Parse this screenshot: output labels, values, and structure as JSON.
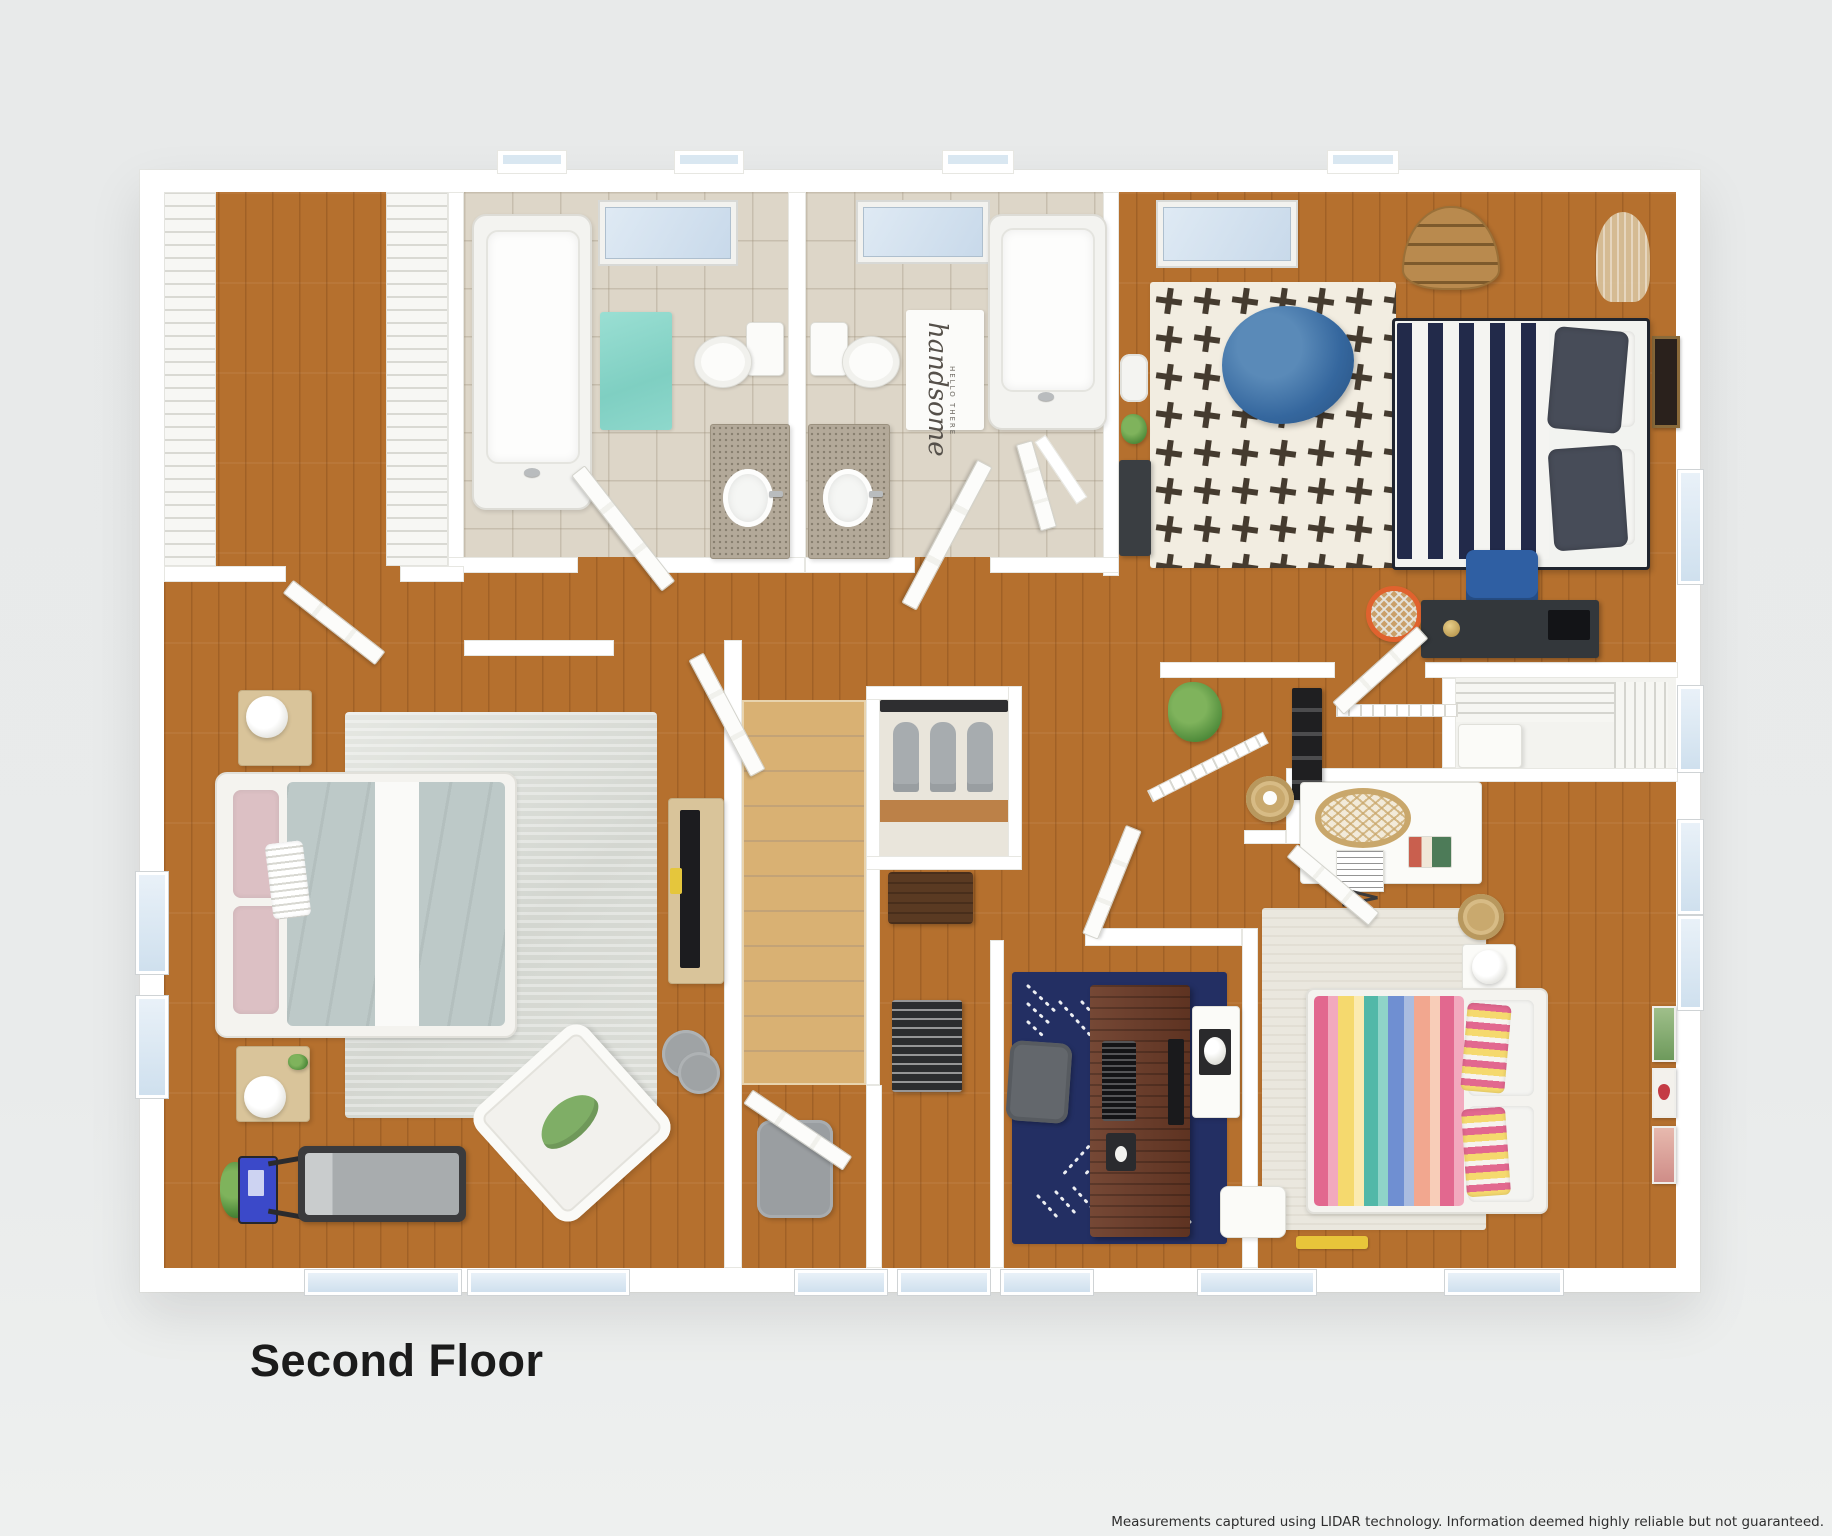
{
  "page": {
    "background_color": "#e9ebeb",
    "title": "Second Floor",
    "disclaimer": "Measurements captured using LIDAR technology. Information deemed highly reliable but not guaranteed."
  },
  "floorplan": {
    "type": "3d-top-down-floor-plan",
    "floor_label": "Second Floor",
    "bath_mat": {
      "line1": "HELLO THERE",
      "line2": "handsome"
    },
    "colors": {
      "wall": "#ffffff",
      "wood_floor": "#b5702e",
      "stair_tread": "#d9b173",
      "bathroom_tile": "#ddd6c8",
      "teal_bath_mat": "#8ed8cc",
      "navy_office_rug": "#232f63",
      "plus_pattern_rug": "#f2ede1",
      "master_rug": "#dcdeD9",
      "rainbow_bed_pink": "#e2688f",
      "rainbow_bed_teal": "#52b8a8",
      "rainbow_bed_blue": "#6f8fd2",
      "navy_bed_stripe": "#222a4a",
      "bean_bag_blue": "#35679e",
      "master_duvet_sage": "#bdc9c8",
      "office_desk_wood": "#6b3a26",
      "treadmill_console_blue": "#3b49c9",
      "basketball_hoop_orange": "#e0622e",
      "window_glass": "#d9e7f1"
    },
    "rooms": [
      {
        "name": "walk-in-closet",
        "furniture": [
          "wire-shelving",
          "hardwood-floor"
        ]
      },
      {
        "name": "bathroom-1",
        "furniture": [
          "bathtub",
          "teal-bath-mat",
          "toilet",
          "vanity-with-sink",
          "skylight"
        ]
      },
      {
        "name": "bathroom-2",
        "furniture": [
          "toilet",
          "handsome-bath-mat",
          "bathtub",
          "vanity-with-sink",
          "skylight",
          "linen-closet"
        ]
      },
      {
        "name": "bedroom-navy",
        "furniture": [
          "navy-striped-bed",
          "plus-pattern-rug",
          "blue-bean-bag",
          "boat-bookshelf",
          "macrame-hanging",
          "wall-art",
          "desk",
          "blue-desk-chair",
          "basketball-hoop",
          "laptop",
          "wire-closet",
          "hamper",
          "plant"
        ]
      },
      {
        "name": "master-bedroom",
        "furniture": [
          "upholstered-bed",
          "two-nightstands",
          "two-lamps",
          "distressed-area-rug",
          "media-console-with-tv",
          "white-armchair",
          "green-pillow",
          "round-side-tables",
          "treadmill",
          "plant"
        ]
      },
      {
        "name": "hallway-landing",
        "furniture": [
          "staircase",
          "stair-railing",
          "balusters",
          "ladder-shelf",
          "plant",
          "basket",
          "wood-bench",
          "gray-pouf"
        ]
      },
      {
        "name": "office",
        "furniture": [
          "dark-wood-desk",
          "monitor",
          "keyboard",
          "mouse-pad",
          "gray-office-chair",
          "navy-pattern-rug",
          "printer-stand",
          "flower-side-table"
        ]
      },
      {
        "name": "bedroom-rainbow",
        "furniture": [
          "rainbow-striped-bed",
          "striped-pillows",
          "white-nightstand",
          "lamp",
          "gold-basket",
          "desk-with-sheet-music",
          "rattan-chair",
          "wall-art",
          "white-bench",
          "yellow-toy",
          "area-rug"
        ]
      }
    ]
  }
}
